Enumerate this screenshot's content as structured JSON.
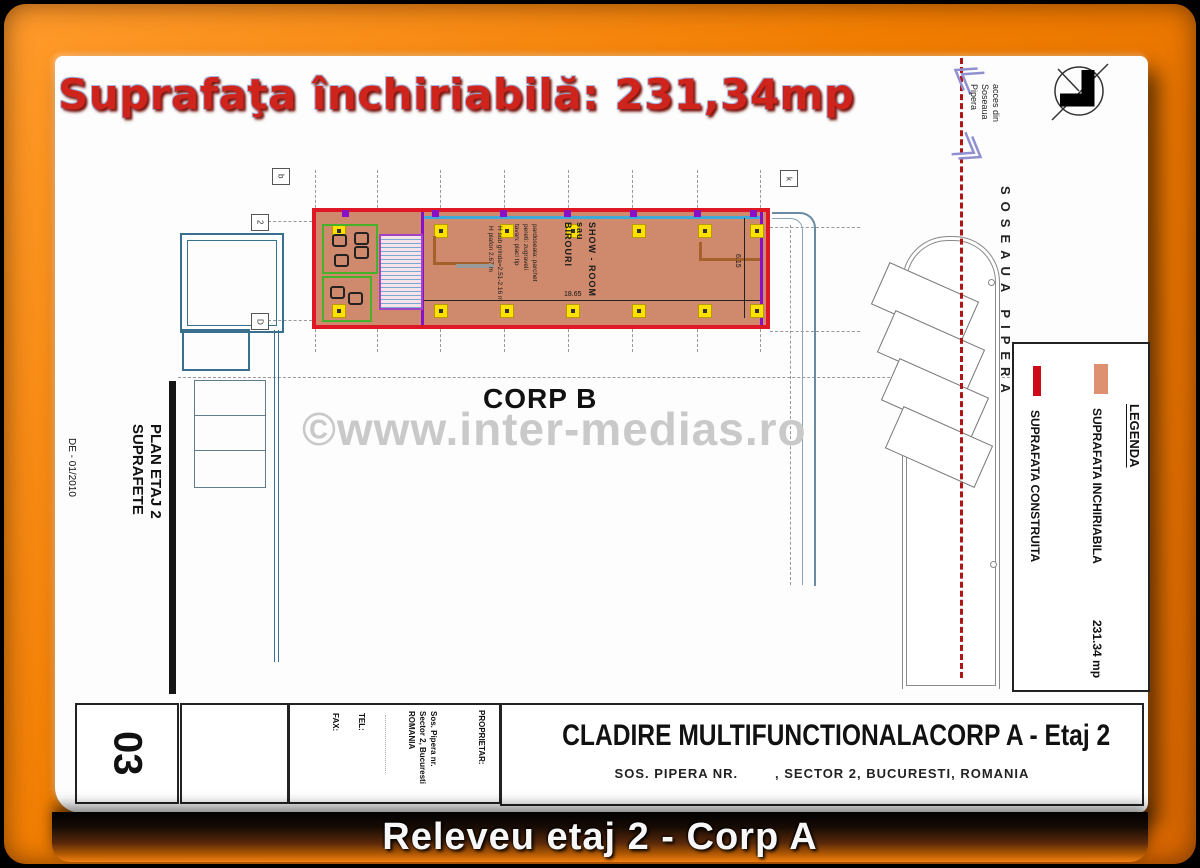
{
  "colors": {
    "frame_orange": "#f07c00",
    "heading_red": "#cf241b",
    "leasable_fill": "#cf8a6d",
    "leasable_border": "#e01826",
    "legend_swatch_inchiriabila": "#dd9170",
    "legend_swatch_construita": "#cc0a18",
    "watermark_gray": "#c9c9c9",
    "banner_orange": "#f28011"
  },
  "header": {
    "title": "Suprafaţa închiriabilă: 231,34mp"
  },
  "site": {
    "road_label": "SOSEAUA PIPERA",
    "access_lines": [
      "acces din",
      "Soseaua",
      "Pipera"
    ]
  },
  "plan": {
    "corp_b_label": "CORP B",
    "grid_labels": [
      "b",
      "2",
      "D",
      "k"
    ],
    "room_label_lines": [
      "SHOW - ROOM",
      "sau",
      "BIROURI"
    ],
    "height_note_lines": [
      "H sub grinda=2.51-2.16 m",
      "H plafon 2.67 m"
    ],
    "finish_note_lines": [
      "pardoseala: parchet",
      "pereti: zugraveli",
      "tavan: placi tip"
    ],
    "dim_width": "18.65",
    "dim_height": "6.15"
  },
  "legend": {
    "title": "LEGENDA",
    "items": [
      {
        "label": "SUPRAFATA INCHIRIABILA",
        "value": "231.34 mp",
        "swatch_color": "#dd9170"
      },
      {
        "label": "SUPRAFATA CONSTRUITA",
        "value": "",
        "swatch_color": "#cc0a18"
      }
    ]
  },
  "margin_notes": {
    "plan_label_lines": [
      "PLAN ETAJ 2",
      "SUPRAFETE"
    ],
    "date_label": "DE  -  01/2010"
  },
  "title_block": {
    "sheet_number": "03",
    "owner_label": "PROPRIETAR:",
    "owner_address_lines": [
      "Sos. Pipera nr.",
      "Sector 2, Bucuresti",
      "ROMANIA"
    ],
    "tel_label": "TEL:",
    "fax_label": "FAX:",
    "project_title": "CLADIRE MULTIFUNCTIONALACORP A - Etaj 2",
    "project_address": "SOS. PIPERA NR.        , SECTOR 2, BUCURESTI, ROMANIA"
  },
  "footer": {
    "caption": "Releveu etaj 2 - Corp A"
  },
  "watermark": {
    "text": "©www.inter-medias.ro"
  }
}
